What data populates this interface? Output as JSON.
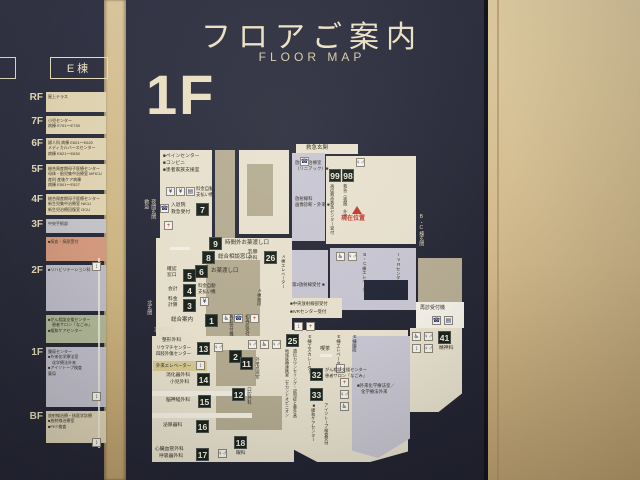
{
  "header": {
    "title_ja": "フロアご案内",
    "title_en": "FLOOR MAP"
  },
  "floor_big": "1F",
  "colors": {
    "sign_bg": "#2b2c3b",
    "wall": "#d5bd8e",
    "badge_bg": "#1b241f",
    "accent_red": "#c2392c",
    "cream": "#e9e2cf",
    "tan": "#b6ad93",
    "lavender": "#c9c7d3",
    "orange": "#d69c80",
    "green": "#b2ba9a",
    "gray": "#bfbeca",
    "yellow": "#d8cc94"
  },
  "sidebar": {
    "building": "E棟",
    "floors": [
      {
        "label": "RF",
        "color": "#e2d6b4",
        "lines": [
          "屋上テラス"
        ]
      },
      {
        "label": "7F",
        "color": "#e2d6b4",
        "lines": [
          "小児センター",
          "病棟 E701〜E735"
        ]
      },
      {
        "label": "6F",
        "color": "#e2d6b4",
        "lines": [
          "婦人科 病棟 E601〜E620",
          "メディカルバースセンター",
          "病棟 E621〜E630"
        ]
      },
      {
        "label": "5F",
        "color": "#e2d6b4",
        "lines": [
          "総合周産期母子医療センター",
          "母体・胎児集中治療室 MFICU",
          "産科 産後ケア病棟",
          "病棟 E501〜E527"
        ]
      },
      {
        "label": "4F",
        "color": "#e2d6b4",
        "lines": [
          "総合周産期母子医療センター",
          "新生児集中治療室 NICU",
          "新生児治療回復室 GCU"
        ]
      },
      {
        "label": "3F",
        "color": "#c6c6cb",
        "lines": [
          "中央手術部"
        ]
      },
      {
        "label": "",
        "color": "#d69c80",
        "lines": [
          "■採血・採尿受付"
        ]
      },
      {
        "label": "2F",
        "color": "#bfbeca",
        "lines": [
          "■リハビリテーション科"
        ]
      },
      {
        "label": "",
        "color": "#b2ba9a",
        "lines": [
          "■がん相談支援センター",
          "　患者サロン「なごみ」",
          "■緩和ケアセンター"
        ]
      },
      {
        "label": "1F",
        "color": "#c2c1cc",
        "lines": [
          "腫瘍センター",
          "■外来化学療法室",
          "　化学療法外来",
          "■アイソトープ検査",
          "薬局"
        ]
      },
      {
        "label": "BF",
        "color": "#ddd3b6",
        "lines": [
          "放射線治療・核医学診療",
          "■放射線治療室",
          "■PET検査"
        ]
      }
    ]
  },
  "map": {
    "ent_emergency": "救急玄関",
    "ent_night_l": "救急",
    "ent_night_r": "夜間玄関",
    "ent_north": "北玄関",
    "ent_main_1": "正面玄関",
    "ent_main_2": "ホール",
    "ent_bc": "B・C棟玄関",
    "current": "現在位置",
    "pain": "■ペインセンター",
    "conv": "■コンビニ",
    "family": "■患者家族支援室",
    "paymach_1": "料金自動",
    "paymach_2": "支払い機",
    "adm_no": "7",
    "adm_1": "入退院",
    "adm_2": "救急受付",
    "linac_1": "放射線治療室",
    "linac_2": "（リニアック）■",
    "rad_1": "放射線科",
    "rad_2": "画像診断・外来 ■",
    "n9": "9",
    "n9_l": "時間外お薬渡し口",
    "n8": "8",
    "n8_l": "総合相談窓口",
    "n6": "6",
    "n6_l": "お薬渡し口",
    "n5": "5",
    "n5_l1": "確認",
    "n5_l2": "窓口",
    "n4": "4",
    "n4_l": "会計",
    "n4_r1": "料金自動",
    "n4_r2": "支払い機",
    "n3": "3",
    "n3_l1": "料金",
    "n3_l2": "計算",
    "n1": "1",
    "n1_l": "総合案内",
    "n2": "2",
    "n2_v1": "再診受付機",
    "n2_v2": "初再診受付",
    "n26": "26",
    "n26_l1": "乳腺",
    "n26_l2": "外科",
    "n99": "99",
    "n99_v": "高度救命救急センター受付",
    "n98": "98",
    "n98_v": "救急（夜間）外来",
    "rad2": "第2放射線受付 ■",
    "rad_c": "■中央放射線部受付",
    "ivr": "■IVRセンター受付",
    "ivr_v": "IVRセンター受付",
    "elev_a": "A棟エレベーター",
    "stair_a": "A棟階段",
    "elev_bc": "B・C棟エレベーター",
    "kiosk": "再診受付機",
    "n13": "13",
    "n13_l1": "整形外科",
    "n13_l2": "リウマチセンター",
    "n13_l3": "四肢外傷センター",
    "elev_out": "外来エレベーター",
    "n14": "14",
    "n14_l1": "消化器外科",
    "n14_l2": "小児外科",
    "n15": "15",
    "n15_l": "脳神経外科",
    "n16": "16",
    "n16_l": "泌尿器科",
    "n17": "17",
    "n17_l1": "心臓血管外科",
    "n17_l2": "呼吸器外科",
    "n18": "18",
    "n18_l": "眼科",
    "n11": "11",
    "n11_v": "外来点滴室",
    "n12": "12",
    "n12_v": "口腔外科",
    "n25": "25",
    "n25_v1": "地域医療連携室（セカンドオピニオン",
    "n25_v2": "遺伝カウンセリング・認知症と薬外来）",
    "n41": "41",
    "n41_l": "精神科",
    "n32": "32",
    "n32_l1": "がん相談支援センター",
    "n32_l2": "患者サロン「なごみ」",
    "n33": "33",
    "n33_v": "■緩和ケアセンター",
    "isotope_v": "アイソトープ検査受付",
    "chemo_1": "■外来化学療法室／",
    "chemo_2": "化学療法外来",
    "esc_e": "E棟エスカレーター",
    "cafe": "喫茶",
    "elev_e": "E棟エレベーター",
    "stair_e": "E棟階段"
  }
}
